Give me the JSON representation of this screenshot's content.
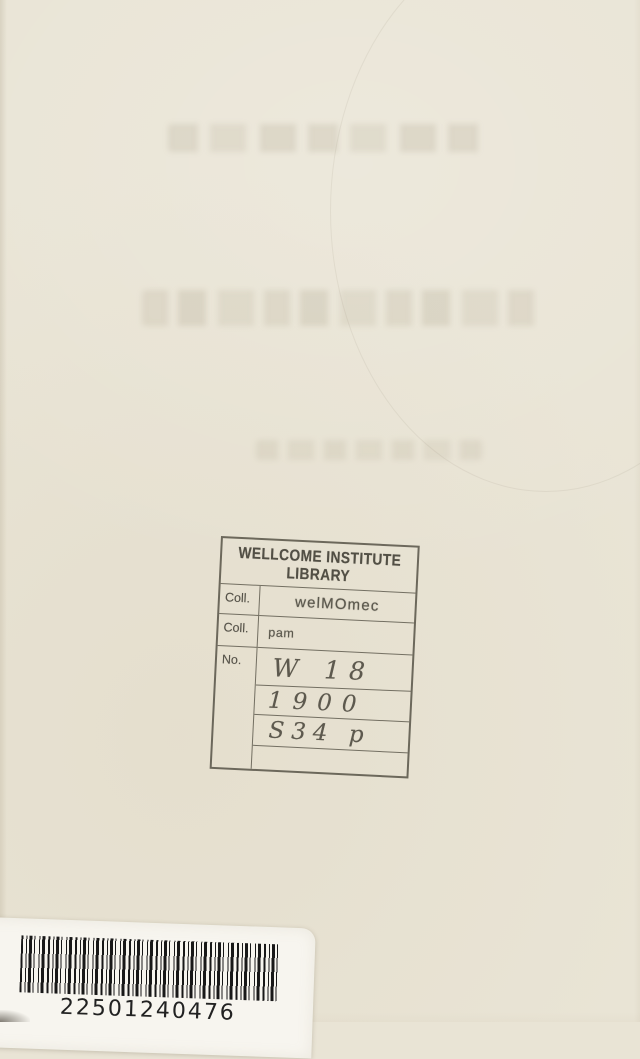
{
  "page": {
    "paper_color": "#e9e4d5"
  },
  "library_stamp": {
    "ink_color": "#56534a",
    "header": {
      "line1": "WELLCOME INSTITUTE",
      "line2": "LIBRARY"
    },
    "rows": [
      {
        "label": "Coll.",
        "value": "welMOmec",
        "style": "stamped"
      },
      {
        "label": "Coll.",
        "value": "pam",
        "style": "stamped"
      },
      {
        "label": "No.",
        "value": "W 18",
        "style": "handwritten"
      },
      {
        "label": "",
        "value": "1900",
        "style": "handwritten"
      },
      {
        "label": "",
        "value": "S34 p",
        "style": "handwritten"
      },
      {
        "label": "",
        "value": "",
        "style": "empty"
      }
    ]
  },
  "barcode_label": {
    "number": "22501240476",
    "background_color": "#f7f5ef",
    "text_color": "#222222"
  }
}
